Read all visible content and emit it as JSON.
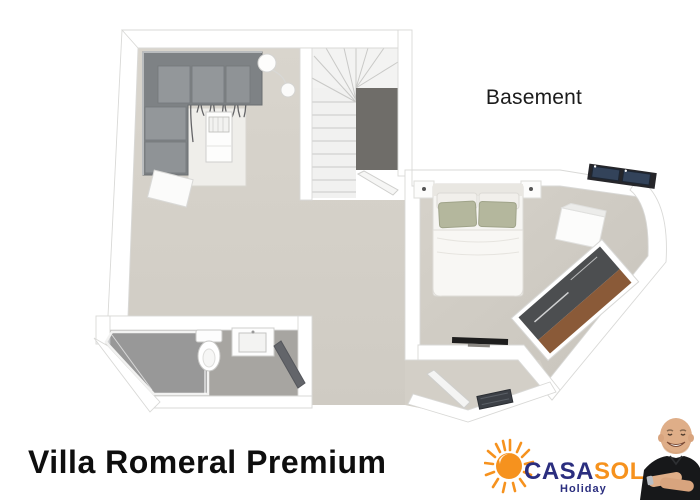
{
  "floor_plan": {
    "label": "Basement",
    "rooms": [
      "living-room",
      "staircase",
      "hallway",
      "bedroom",
      "bathroom",
      "entry-hall"
    ],
    "furniture": {
      "living_room": [
        "corner-sofa",
        "striped-rug",
        "coffee-table",
        "arc-floor-lamp",
        "side-table"
      ],
      "staircase": [
        "winder-stairs",
        "stair-void",
        "stair-door"
      ],
      "bedroom": [
        "double-bed",
        "green-pillows",
        "nightstand-left",
        "nightstand-right",
        "wall-shelf",
        "angled-wardrobe",
        "tv",
        "skylight-windows"
      ],
      "bathroom": [
        "walk-in-shower",
        "toilet",
        "washbasin",
        "bathroom-door"
      ],
      "entry_hall": [
        "entry-door",
        "doormat"
      ]
    }
  },
  "footer": {
    "title": "Villa Romeral Premium"
  },
  "logo": {
    "brand_casa": "CASA",
    "brand_sol": "SOL",
    "tagline": "Holiday",
    "icon": "sun-icon",
    "colors": {
      "navy": "#2b2e7f",
      "orange": "#f6921e"
    }
  },
  "photo": {
    "subject": "smiling-agent-black-polo"
  },
  "palette": {
    "floor": "#d7d3cb",
    "bedroom_floor": "#d2cec6",
    "bathroom_floor": "#a7a5a1",
    "stair_void": "#6f6d69",
    "wall": "#ffffff",
    "sofa": "#83878a",
    "wood": "#8a5a38",
    "wardrobe_dark": "#4c4e50",
    "window_dark": "#33435a"
  }
}
